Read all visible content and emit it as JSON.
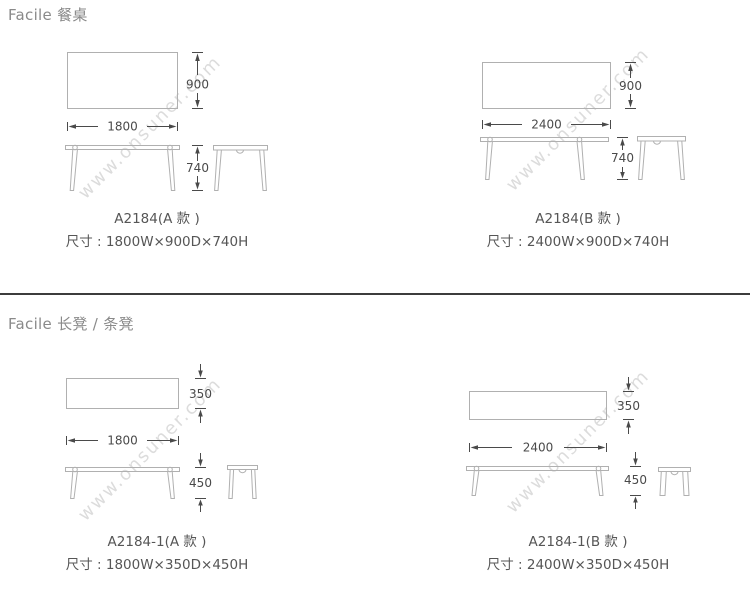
{
  "sections": {
    "tables_header": "Facile 餐桌",
    "benches_header": "Facile 长凳 / 条凳"
  },
  "watermark": "www.onsuner.com",
  "products": {
    "table_a": {
      "code": "A2184(A 款 )",
      "size": "尺寸 : 1800W×900D×740H",
      "width": "1800",
      "depth": "900",
      "height": "740"
    },
    "table_b": {
      "code": "A2184(B 款 )",
      "size": "尺寸 : 2400W×900D×740H",
      "width": "2400",
      "depth": "900",
      "height": "740"
    },
    "bench_a": {
      "code": "A2184-1(A 款 )",
      "size": "尺寸 : 1800W×350D×450H",
      "width": "1800",
      "depth": "350",
      "height": "450"
    },
    "bench_b": {
      "code": "A2184-1(B 款 )",
      "size": "尺寸 : 2400W×350D×450H",
      "width": "2400",
      "depth": "350",
      "height": "450"
    }
  },
  "colors": {
    "background": "#ffffff",
    "header": "#8a8a8a",
    "label": "#565656",
    "dim": "#4a4a4a",
    "line": "#b0b0b0",
    "divider": "#3c3c3c",
    "watermark": "#dcdcdc"
  }
}
